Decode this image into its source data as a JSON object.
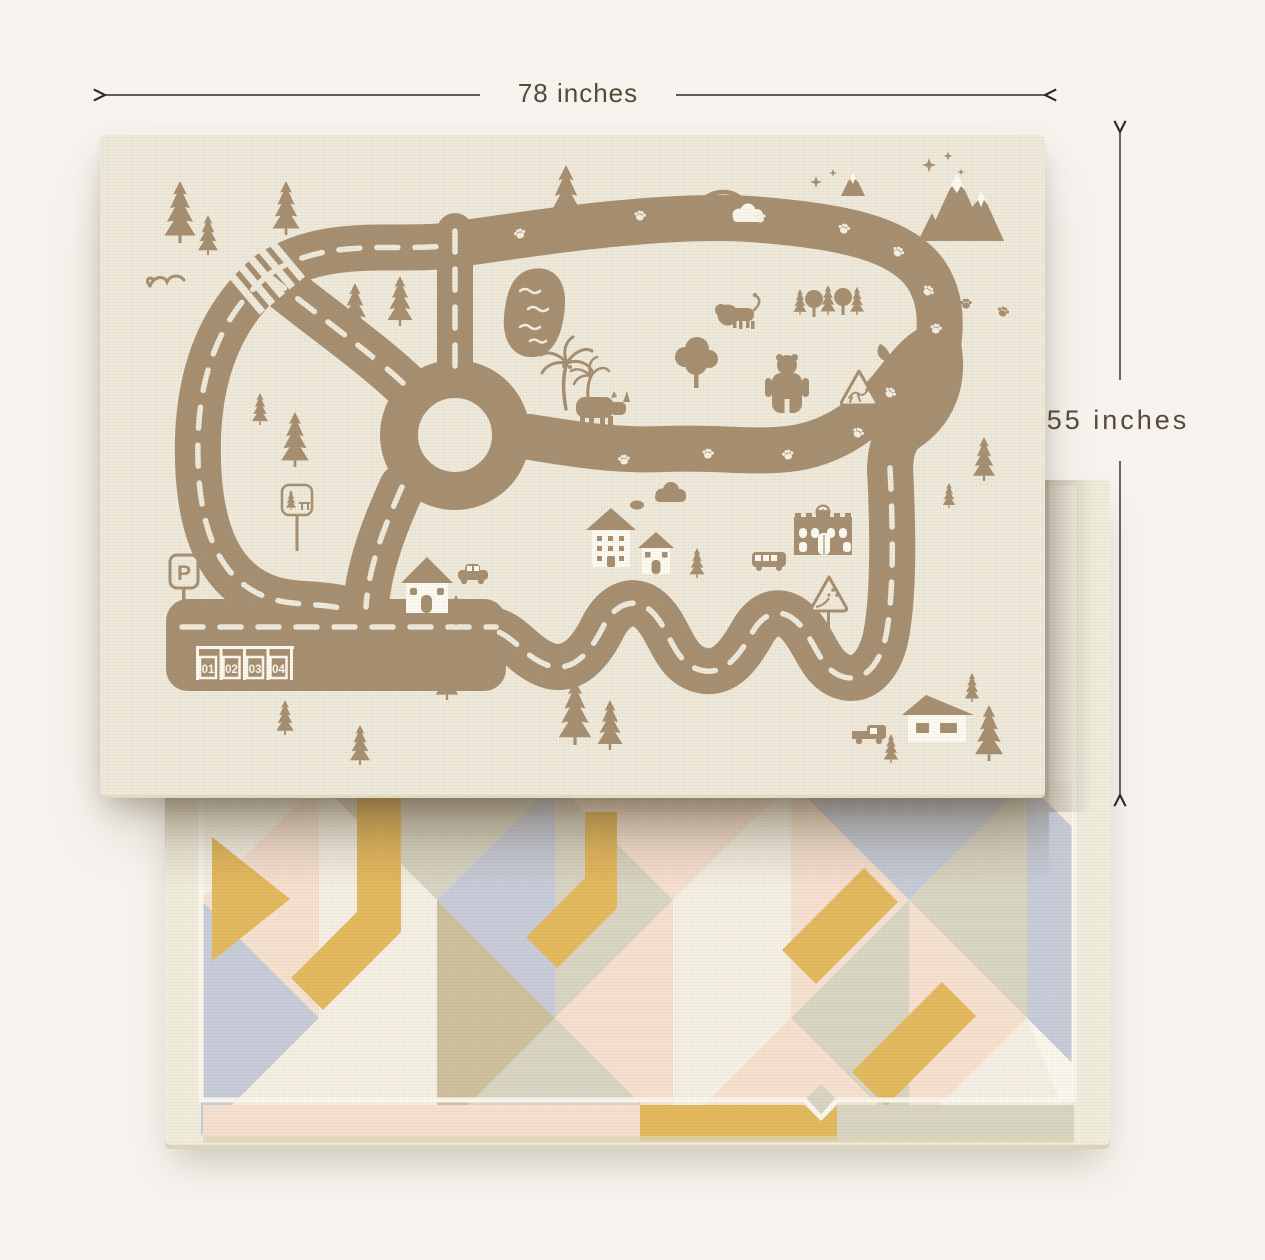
{
  "page": {
    "background_color": "#f6f3ee"
  },
  "annotations": {
    "width_label": "78 inches",
    "height_label": "55 inches",
    "line_color": "#2e2922",
    "text_color": "#57493a"
  },
  "mat_front": {
    "description": "reversible baby play mat - road map print side",
    "base_color": "#efeadb",
    "print_color": "#a78f71",
    "parking": {
      "sign_label": "P",
      "space_numbers": [
        "01",
        "02",
        "03",
        "04"
      ]
    },
    "illustrations": [
      "road-loop",
      "dashed-lane-markings",
      "roundabout",
      "crosswalk",
      "parking-lot",
      "pond",
      "rainbow",
      "clouds",
      "mountains",
      "stars",
      "pine-trees",
      "palm-trees",
      "bird",
      "lion",
      "bear",
      "fox",
      "rhino",
      "houses",
      "school-building",
      "bus",
      "car",
      "pickup-truck",
      "park-sign",
      "animal-crossing-sign",
      "falling-rocks-sign",
      "paw-prints"
    ]
  },
  "mat_back": {
    "description": "reversible baby play mat - geometric pattern side",
    "base_color": "#f2eedd",
    "palette": [
      "#e4ba5f",
      "#f7e2d1",
      "#c8cdda",
      "#dad6c4",
      "#f5f1e4",
      "#cfc0a0",
      "#fbf8ef"
    ]
  }
}
